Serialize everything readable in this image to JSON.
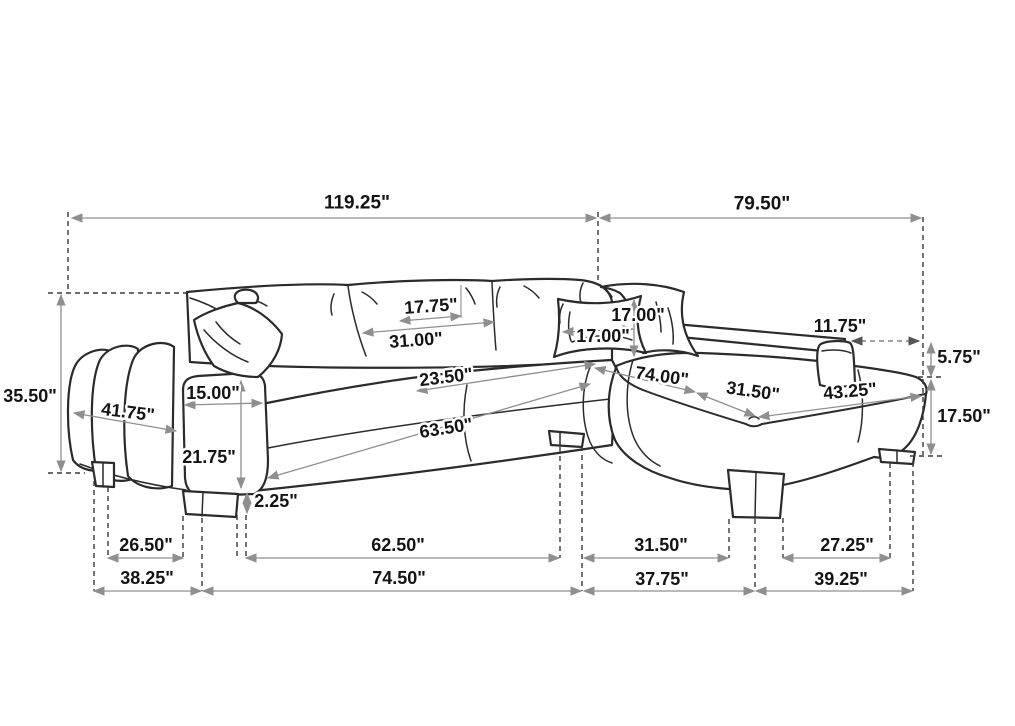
{
  "colors": {
    "background": "#ffffff",
    "sofa_outline": "#2b2b2b",
    "dimension_line": "#8f8f8f",
    "extension_line": "#3a3a3a",
    "label_text": "#141414"
  },
  "units": "inches",
  "dims": {
    "overall_left": "119.25\"",
    "overall_right": "79.50\"",
    "back_height": "35.50\"",
    "arm_diagonal": "41.75\"",
    "arm_top_width": "15.00\"",
    "arm_front_height": "21.75\"",
    "leg_height": "2.25\"",
    "back_cushion_depth": "17.75\"",
    "back_cushion_width": "31.00\"",
    "seat_depth": "23.50\"",
    "seat_length": "63.50\"",
    "pillow_height": "17.00\"",
    "pillow_width": "17.00\"",
    "chaise_length": "74.00\"",
    "chaise_width": "31.50\"",
    "chaise_side": "43.25\"",
    "arm_setback": "11.75\"",
    "arm_above_seat": "5.75\"",
    "seat_height": "17.50\"",
    "base_left_inner": "26.50\"",
    "base_left_outer": "38.25\"",
    "base_mid_inner": "62.50\"",
    "base_mid_outer": "74.50\"",
    "base_right_inner": "31.50\"",
    "base_right_outer": "37.75\"",
    "base_far_inner": "27.25\"",
    "base_far_outer": "39.25\""
  }
}
